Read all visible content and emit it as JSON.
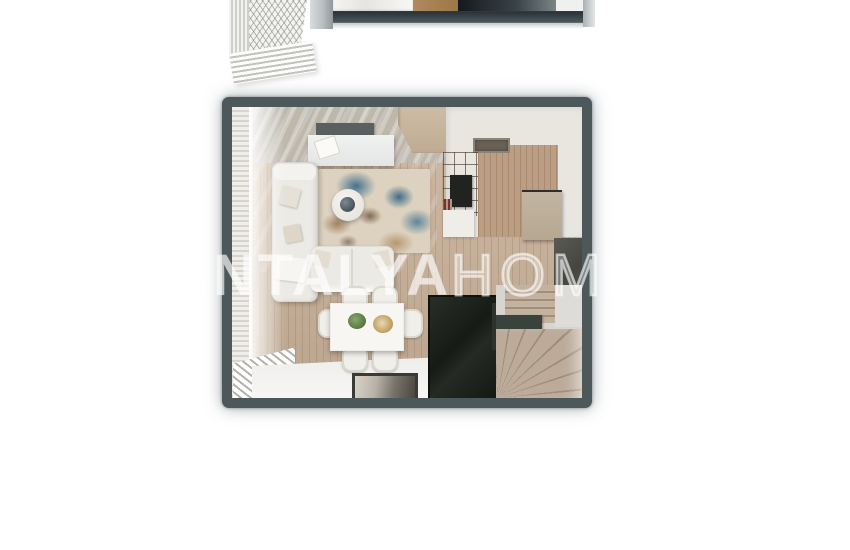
{
  "meta": {
    "type": "real-estate-floor-plan-render",
    "view": "top-down 3D apartment render, white page background"
  },
  "watermark": {
    "bold": "ANTALYA",
    "light": "HOMES",
    "color": "#ffffff"
  },
  "palette": {
    "plan_frame": "#4d585b",
    "wood_floor": "#c9b199",
    "kitchen_wood": "#bc9e83",
    "gray_concrete_floor": "#bdb7ac",
    "kitchen_white_floor": "#e9e6e0",
    "rug_base": "#dcd2bf",
    "rug_blue": "#3c6b8a",
    "rug_brown": "#9b7a57",
    "sofa_white": "#eceae5",
    "wardrobe_black": "#171b16",
    "stair_wood": "#b3a08c",
    "upper_strip_bar": "#353f43"
  },
  "elements": [
    "upper-floor-fragment",
    "balcony-railing-lattice",
    "living-room",
    "wall-tv",
    "tv-console",
    "corner-sofa",
    "two-seat-sofa",
    "area-rug",
    "round-coffee-table",
    "dining-table",
    "dining-chairs-x6",
    "door-mat",
    "window-curtain",
    "louver-blinds",
    "kitchen-counter",
    "cooktop",
    "shelf-divider-unit",
    "kitchen-appliance-block",
    "dark-wall-panel",
    "black-wardrobe",
    "winder-staircase"
  ]
}
